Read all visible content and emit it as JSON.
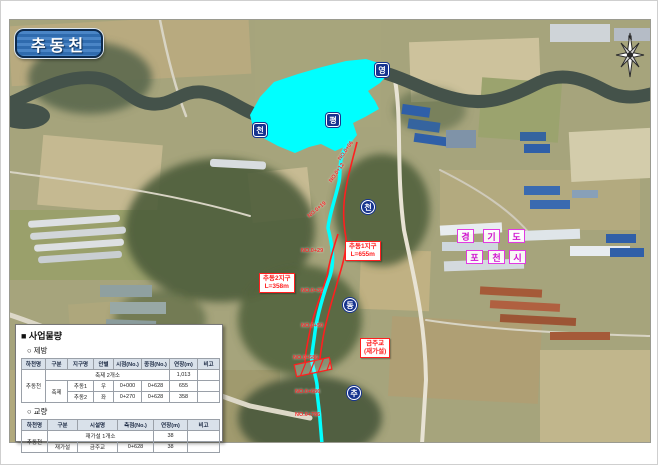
{
  "title_badge": "추동천",
  "compass": {
    "label": "N"
  },
  "colors": {
    "highlight_cyan": "#00ffff",
    "alignment_red": "#ff1f1f",
    "marker_blue": "#16338f",
    "admin_magenta": "#cf12cf",
    "badge_blue": "#2f6bae"
  },
  "map": {
    "river_name": [
      "영",
      "평",
      "천"
    ],
    "stream_name": [
      "천",
      "동",
      "추"
    ],
    "province": [
      "경",
      "기",
      "도"
    ],
    "city": [
      "포",
      "천",
      "시"
    ],
    "callouts": [
      {
        "title": "추동1지구",
        "sub": "L=655m"
      },
      {
        "title": "추동2지구",
        "sub": "L=358m"
      },
      {
        "title": "금주교",
        "sub": "(재가설)"
      }
    ],
    "stations": [
      {
        "text": "NO.0+06"
      },
      {
        "text": "NO.0+12"
      },
      {
        "text": "NO.0+19"
      },
      {
        "text": "NO.0+29"
      },
      {
        "text": "NO.0+35"
      },
      {
        "text": "NO.0+50"
      },
      {
        "text": "NO.0+586"
      },
      {
        "text": "NO.0+686"
      },
      {
        "text": "NO.0+786"
      }
    ]
  },
  "panel": {
    "title": "■ 사업물량",
    "levee": {
      "heading": "○ 제방",
      "headers": [
        "하천명",
        "구분",
        "지구명",
        "안별",
        "시점(No.)",
        "종점(No.)",
        "연장(m)",
        "비고"
      ],
      "river": "추동천",
      "summary_label": "축제 2개소",
      "summary_total": "1,013",
      "summary_note": "",
      "rows": [
        {
          "gubun": "축제",
          "district": "추동1",
          "side": "우",
          "start": "0+000",
          "end": "0+628",
          "length": "655",
          "note": ""
        },
        {
          "district": "추동2",
          "side": "좌",
          "start": "0+270",
          "end": "0+628",
          "length": "358",
          "note": ""
        }
      ]
    },
    "bridge": {
      "heading": "○ 교량",
      "headers": [
        "하천명",
        "구분",
        "시설명",
        "측점(No.)",
        "연장(m)",
        "비고"
      ],
      "river": "추동천",
      "summary_label": "재가설 1개소",
      "summary_total": "38",
      "summary_note": "",
      "rows": [
        {
          "gubun": "재가설",
          "facility": "금주교",
          "station": "0+628",
          "length": "38",
          "note": ""
        }
      ]
    }
  }
}
